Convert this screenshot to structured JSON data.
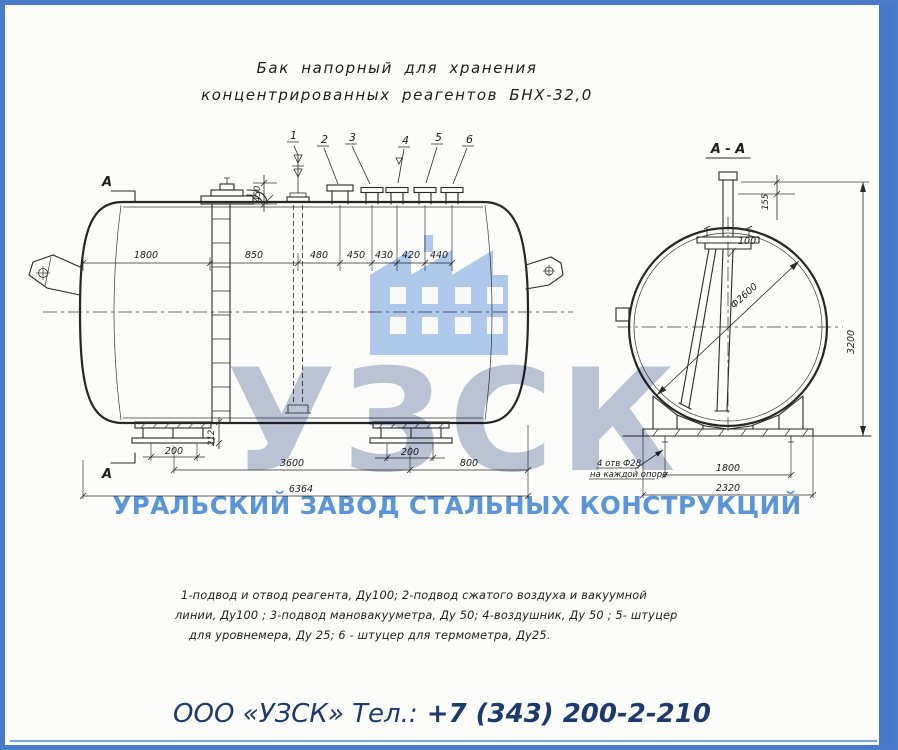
{
  "page": {
    "border_color": "#4a7bc8",
    "stripe_color": "#4777c6",
    "paper_color": "#fcfcfb",
    "ink_color": "#2a2a2a"
  },
  "drawing": {
    "title": [
      "Бак напорный для хранения",
      "концентрированных реагентов БНХ-32,0"
    ],
    "section_label": "А - А",
    "cut_mark": "А",
    "callouts": [
      "1",
      "2",
      "3",
      "4",
      "5",
      "6"
    ],
    "dims": {
      "top": [
        "1800",
        "850",
        "480",
        "450",
        "430",
        "420",
        "440"
      ],
      "stub_height": "450",
      "support_height": "212",
      "left_offset": "200",
      "right_offset": "200",
      "span": "3600",
      "right_end": "800",
      "overall": "6364",
      "sec_top": "155",
      "sec_pipe": "100",
      "sec_dia": "Ф2600",
      "sec_height": "3200",
      "sec_holes": "1800",
      "sec_base": "2320"
    },
    "holes_note": [
      "4 отв Ф28",
      "на каждой опоре"
    ],
    "notes": [
      "1-подвод и отвод реагента, Ду100;  2-подвод сжатого воздуха и вакуумной",
      "линии, Ду100 ;  3-подвод мановакууметра, Ду 50;   4-воздушник, Ду 50 ; 5- штуцер",
      "для  уровнемера, Ду 25; 6 - штуцер для  термометра, Ду25."
    ]
  },
  "watermark": {
    "logo": "УЗСК",
    "caption": "УРАЛЬСКИЙ ЗАВОД СТАЛЬНЫХ КОНСТРУКЦИЙ",
    "logo_color": "#b6c0d5",
    "icon_color": "#abc8ee",
    "caption_color": "#4d8ed8"
  },
  "footer": {
    "company": "ООО «УЗСК» Тел.:",
    "phone": "+7 (343) 200-2-210",
    "text_color": "#1d3a6e"
  }
}
